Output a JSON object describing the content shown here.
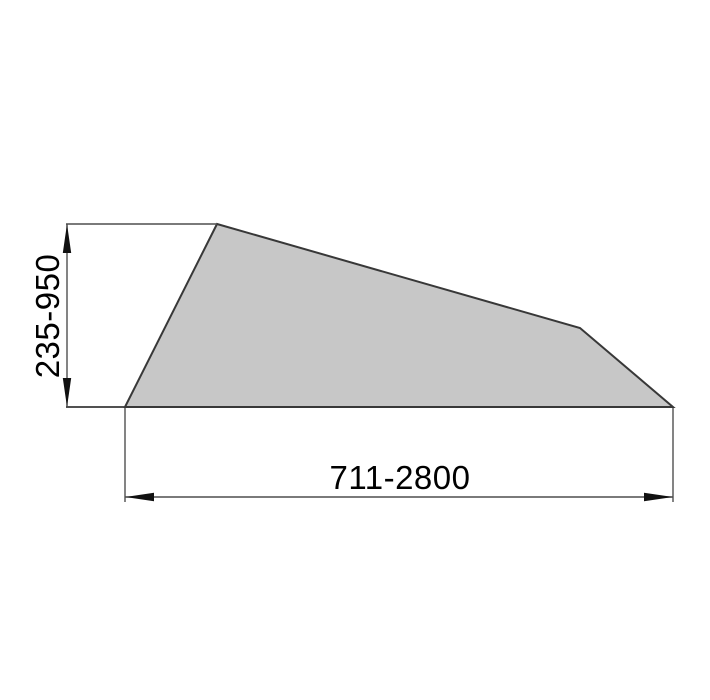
{
  "diagram": {
    "type": "technical-dimension-drawing",
    "labels": {
      "height": "235-950",
      "width": "711-2800"
    },
    "height_range": {
      "min": 235,
      "max": 950
    },
    "width_range": {
      "min": 711,
      "max": 2800
    },
    "colors": {
      "background": "#ffffff",
      "shape_fill": "#c7c7c7",
      "shape_outline": "#383838",
      "dimension_line": "#4f4f4f",
      "arrow": "#111111",
      "text": "#000000"
    }
  }
}
